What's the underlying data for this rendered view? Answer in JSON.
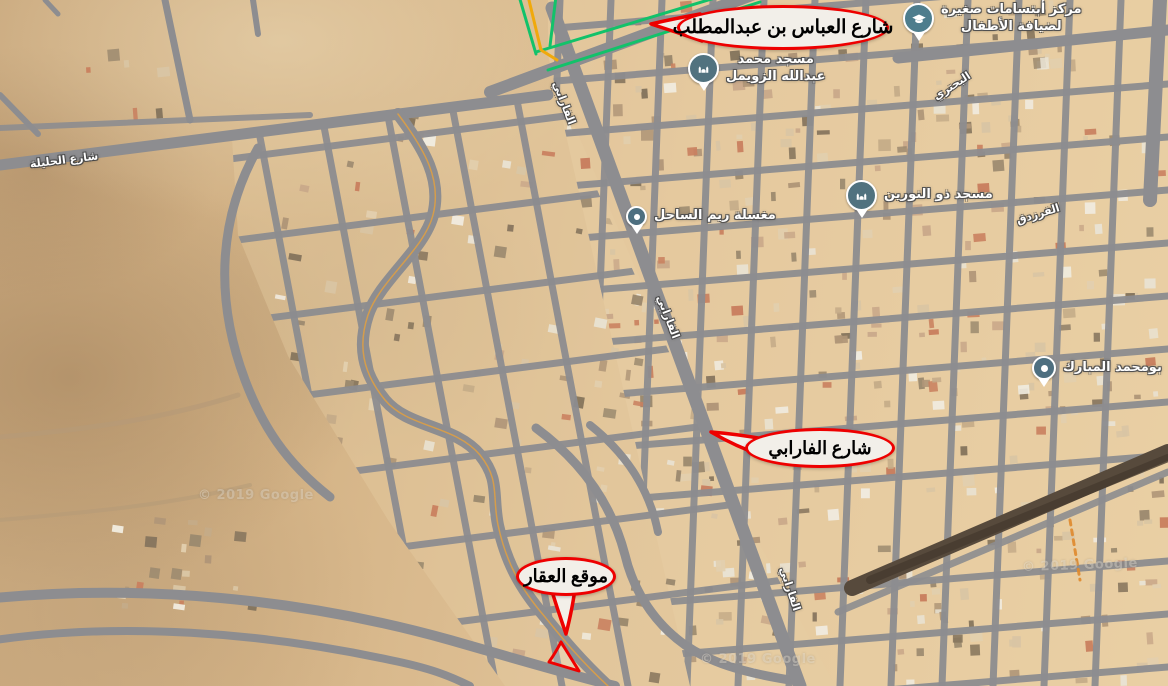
{
  "callouts": {
    "abbas": {
      "label": "شارع العباس بن عبدالمطلب"
    },
    "farabi": {
      "label": "شارع الفارابي"
    },
    "property": {
      "label": "موقع العقار"
    }
  },
  "pois": {
    "mosque_zuwaimel": {
      "line1": "مسجد محمد",
      "line2": "عبدالله الزويمل"
    },
    "kids_center": {
      "line1": "مركز أبتسامات صغيرة",
      "line2": "لضيافة الأطفال"
    },
    "mosque_nurayn": {
      "label": "مسجد ذو النورين"
    },
    "laundry": {
      "label": "مغسلة ريم الساحل"
    },
    "bumohammad": {
      "label": "بومحمد المبارك"
    }
  },
  "street_labels": {
    "halila": "شارع الحليلة",
    "buhturi": "البحتري",
    "farazdaq": "الفرزدق",
    "farabi_1": "الفارابي",
    "farabi_2": "الفارابي",
    "farabi_3": "الفارابي"
  },
  "watermarks": {
    "w1": "© 2019 Google",
    "w2": "© 2019 Google",
    "w3": "© 2019 Google"
  },
  "colors": {
    "callout_red": "#ee0000",
    "pin_blue": "#51727f",
    "route_green": "#12c26a",
    "route_yellow": "#f0a90b",
    "road_gray": "#8d8d90",
    "railway_dark": "#574a3c"
  }
}
